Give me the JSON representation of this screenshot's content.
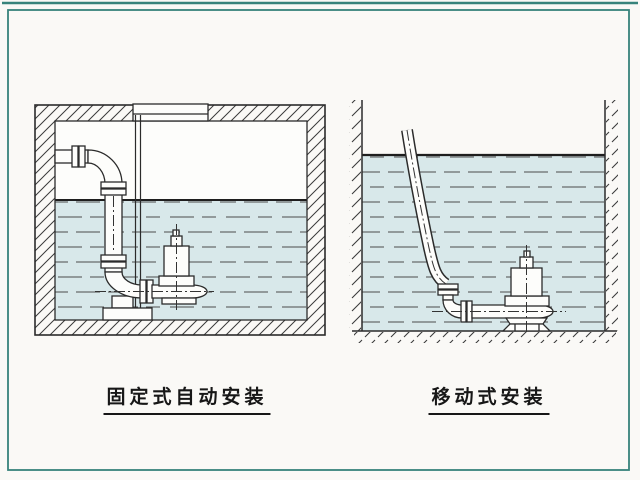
{
  "colors": {
    "frame": "#37837b",
    "water": "#d8e8ea",
    "ink": "#2b2b2b",
    "paper": "#faf9f6"
  },
  "diagrams": {
    "fixed": {
      "caption": "固定式自动安装"
    },
    "portable": {
      "caption": "移动式安装"
    }
  }
}
